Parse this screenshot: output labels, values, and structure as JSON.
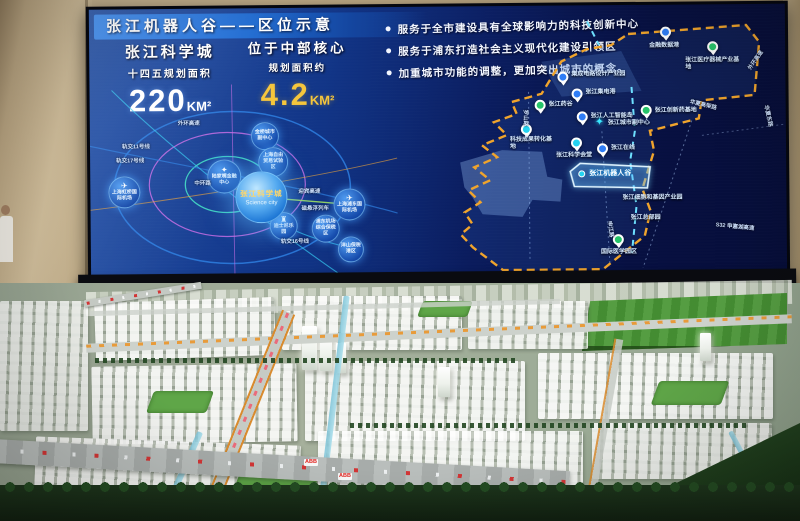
{
  "screen": {
    "title": "张江机器人谷——区位示意",
    "bullets": [
      "服务于全市建设具有全球影响力的科技创新中心",
      "服务于浦东打造社会主义现代化建设引领区",
      "加重城市功能的调整，更加突出城市的概念。"
    ],
    "stats": {
      "left": {
        "name": "张江科学城",
        "caption": "十四五规划面积",
        "value": "220",
        "unit": "KM²"
      },
      "right": {
        "name": "位于中部核心",
        "caption": "规划面积约",
        "value": "4.2",
        "unit": "KM²"
      }
    },
    "icons": {
      "plane": "✈",
      "castle": "♜",
      "tower": "✦",
      "star": "✦"
    },
    "left_map": {
      "science_city": {
        "zh": "张江科学城",
        "en": "Science city"
      },
      "nodes": [
        {
          "label": "陆家嘴金融中心"
        },
        {
          "label": "金桥城市副中心"
        },
        {
          "label": "上海自由贸易试验区"
        },
        {
          "label": "上海虹桥国际机场"
        },
        {
          "label": "上海浦东国际机场"
        },
        {
          "label": "迪士尼乐园"
        },
        {
          "label": "浦东机场综合保税区"
        },
        {
          "label": "洋山保税港区"
        }
      ],
      "road_labels": [
        "轨交11号线",
        "轨交17号线",
        "外环高速",
        "中环路",
        "迎宾高速",
        "磁悬浮列车",
        "轨交16号线"
      ]
    },
    "right_map": {
      "featured": "张江机器人谷",
      "markers": [
        {
          "label": "集成电路设计产业园",
          "color": "blue"
        },
        {
          "label": "张江集电港",
          "color": "blue"
        },
        {
          "label": "张江药谷",
          "color": "green"
        },
        {
          "label": "张江人工智能岛",
          "color": "blue"
        },
        {
          "label": "张江城市副中心",
          "color": "cyan-star"
        },
        {
          "label": "张江在线",
          "color": "blue"
        },
        {
          "label": "张江科学会堂",
          "color": "cyan"
        },
        {
          "label": "科技成果转化基地",
          "color": "cyan"
        },
        {
          "label": "金融数据港",
          "color": "blue"
        },
        {
          "label": "张江医疗器械产业基地",
          "color": "green"
        },
        {
          "label": "张江创新药基地",
          "color": "green"
        },
        {
          "label": "张江细胞和基因产业园",
          "color": "label"
        },
        {
          "label": "张江总部园",
          "color": "label"
        },
        {
          "label": "国际医学园区",
          "color": "green"
        }
      ],
      "road_labels": [
        "华夏高架路",
        "外环高速",
        "华夏东路",
        "罗山路",
        "申江路",
        "S32 申嘉湖高速"
      ]
    }
  },
  "model": {
    "abb": "ABB"
  },
  "colors": {
    "accent_yellow": "#f6c63c",
    "dash_yellow": "#f0a42c",
    "dash_cyan": "#6ee0ff",
    "pin_green": "#27c46a",
    "pin_blue": "#2f7df6",
    "pin_cyan": "#25d3f0",
    "screen_navy": "#0a1c5e"
  }
}
